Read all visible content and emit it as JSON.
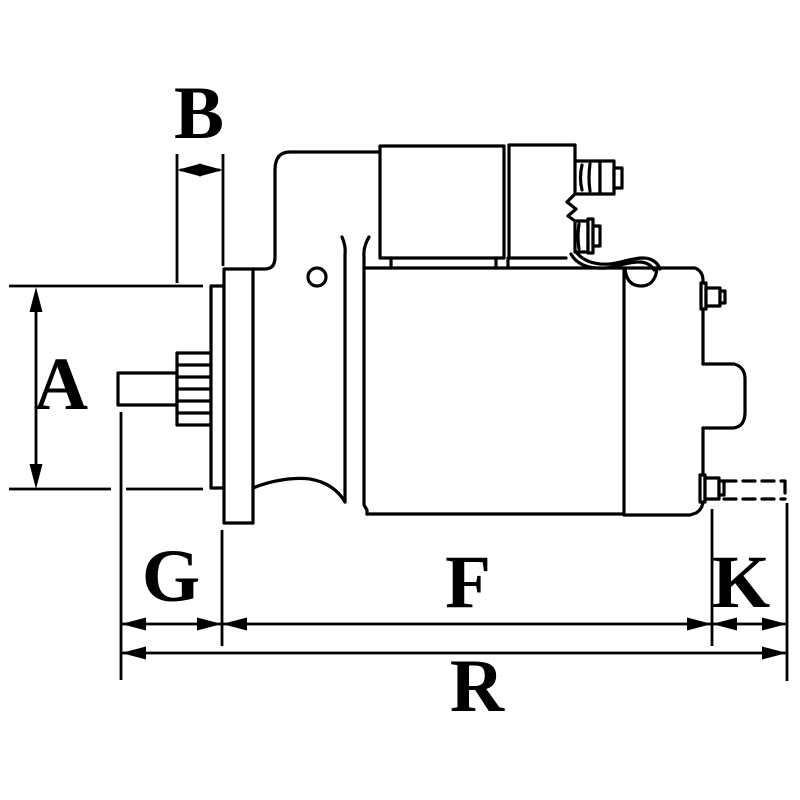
{
  "diagram": {
    "type": "technical-dimension-drawing",
    "depicts": "starter motor side view with dimension callouts",
    "dimension_labels": {
      "a": "A",
      "b": "B",
      "g": "G",
      "f": "F",
      "k": "K",
      "r": "R"
    },
    "colors": {
      "line": "#000000",
      "background": "#ffffff"
    }
  }
}
